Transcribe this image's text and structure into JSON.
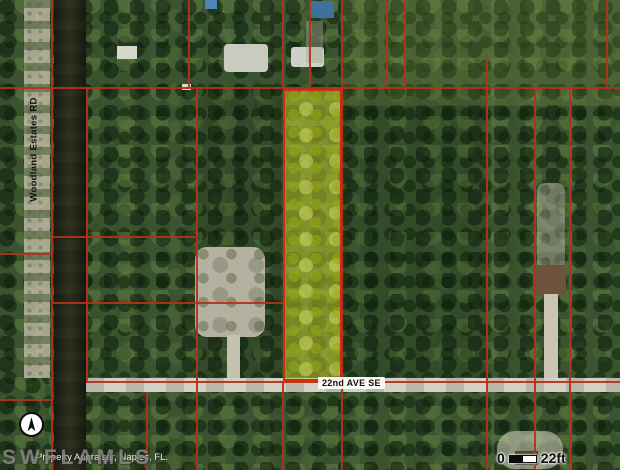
{
  "map": {
    "type": "aerial-parcel-map",
    "labels": {
      "road_horizontal": "22nd AVE SE",
      "road_vertical": "Woodland Estates RD"
    },
    "scale_bar": {
      "start": "0",
      "end": "22ft"
    },
    "watermark": "SWFLAMLS",
    "attribution": "Property Appraiser, Naples, FL.",
    "colors": {
      "parcel_line": "#b3321c",
      "highlight_border": "#d42a10",
      "highlight_fill": "rgba(200,210,40,0.5)",
      "canal": "#232a1b",
      "road": "#d3d0c6",
      "forest_base": "#3a5430"
    },
    "north_arrow_icon": "north-arrow-icon",
    "highlight_parcel": {
      "x": 283,
      "y": 89,
      "w": 59,
      "h": 292
    },
    "parcel_lines": [
      {
        "x": 0,
        "y": 87,
        "w": 620,
        "h": 2
      },
      {
        "x": 51,
        "y": 236,
        "w": 146,
        "h": 2
      },
      {
        "x": 51,
        "y": 302,
        "w": 232,
        "h": 2
      },
      {
        "x": 0,
        "y": 253,
        "w": 51,
        "h": 2
      },
      {
        "x": 86,
        "y": 381,
        "w": 534,
        "h": 2
      },
      {
        "x": 0,
        "y": 399,
        "w": 51,
        "h": 2
      },
      {
        "x": 51,
        "y": 0,
        "w": 2,
        "h": 470
      },
      {
        "x": 86,
        "y": 88,
        "w": 2,
        "h": 295
      },
      {
        "x": 146,
        "y": 392,
        "w": 2,
        "h": 78
      },
      {
        "x": 188,
        "y": 0,
        "w": 2,
        "h": 88
      },
      {
        "x": 196,
        "y": 88,
        "w": 2,
        "h": 382
      },
      {
        "x": 282,
        "y": 0,
        "w": 2,
        "h": 90
      },
      {
        "x": 282,
        "y": 383,
        "w": 2,
        "h": 87
      },
      {
        "x": 309,
        "y": 0,
        "w": 2,
        "h": 88
      },
      {
        "x": 341,
        "y": 0,
        "w": 2,
        "h": 470
      },
      {
        "x": 386,
        "y": 0,
        "w": 2,
        "h": 88
      },
      {
        "x": 404,
        "y": 0,
        "w": 2,
        "h": 88
      },
      {
        "x": 486,
        "y": 55,
        "w": 2,
        "h": 415
      },
      {
        "x": 534,
        "y": 88,
        "w": 2,
        "h": 382
      },
      {
        "x": 569,
        "y": 88,
        "w": 2,
        "h": 382
      },
      {
        "x": 606,
        "y": 0,
        "w": 2,
        "h": 88
      }
    ],
    "structures": [
      {
        "name": "left-trail",
        "cls": "trail",
        "x": 24,
        "y": 0,
        "w": 26,
        "h": 378
      },
      {
        "name": "top-right-light-area",
        "cls": "plain",
        "x": 342,
        "y": 0,
        "w": 278,
        "h": 106,
        "color": "rgba(130,150,70,0.22)"
      },
      {
        "name": "dark-tint-left-of-parcel",
        "cls": "plain",
        "x": 197,
        "y": 88,
        "w": 85,
        "h": 292,
        "color": "rgba(10,25,8,0.16)"
      },
      {
        "name": "dark-tint-right-of-parcel",
        "cls": "plain",
        "x": 344,
        "y": 88,
        "w": 142,
        "h": 292,
        "color": "rgba(10,25,8,0.14)"
      },
      {
        "name": "swimming-pool",
        "cls": "plain",
        "x": 205,
        "y": 0,
        "w": 12,
        "h": 9,
        "color": "#4e86b4"
      },
      {
        "name": "house-roof-a",
        "cls": "plain",
        "x": 117,
        "y": 46,
        "w": 20,
        "h": 13,
        "color": "#d6d7cd"
      },
      {
        "name": "house-roof-b",
        "cls": "plain",
        "x": 224,
        "y": 44,
        "w": 44,
        "h": 28,
        "color": "#cbcabf",
        "radius": 4
      },
      {
        "name": "shed-roof",
        "cls": "plain",
        "x": 182,
        "y": 84,
        "w": 9,
        "h": 6,
        "color": "#d9d9cd"
      },
      {
        "name": "house-roof-c",
        "cls": "plain",
        "x": 291,
        "y": 47,
        "w": 33,
        "h": 20,
        "color": "#ced1c7",
        "radius": 3
      },
      {
        "name": "blue-roof-house",
        "cls": "plain",
        "x": 309,
        "y": 1,
        "w": 25,
        "h": 17,
        "color": "#3f719f"
      },
      {
        "name": "yard-patch",
        "cls": "plain",
        "x": 306,
        "y": 21,
        "w": 17,
        "h": 42,
        "color": "rgba(165,165,145,0.45)"
      },
      {
        "name": "cleared-lot",
        "cls": "clearing",
        "x": 195,
        "y": 247,
        "w": 70,
        "h": 90,
        "radius": 12
      },
      {
        "name": "driveway-left",
        "cls": "plain",
        "x": 227,
        "y": 335,
        "w": 13,
        "h": 46,
        "color": "#c6c2b0"
      },
      {
        "name": "cleared-strip-right",
        "cls": "clearing",
        "x": 537,
        "y": 183,
        "w": 28,
        "h": 86,
        "radius": 8,
        "opacity": 0.55
      },
      {
        "name": "house-roof-brown",
        "cls": "plain",
        "x": 533,
        "y": 265,
        "w": 33,
        "h": 30,
        "color": "#6e523c",
        "radius": 2
      },
      {
        "name": "driveway-right",
        "cls": "plain",
        "x": 544,
        "y": 294,
        "w": 14,
        "h": 86,
        "color": "#c9c5b2"
      },
      {
        "name": "circular-driveway",
        "cls": "plain",
        "x": 497,
        "y": 431,
        "w": 66,
        "h": 38,
        "color": "rgba(205,200,184,0.6)",
        "radius": 18
      },
      {
        "name": "house-roof-dark",
        "cls": "plain",
        "x": 515,
        "y": 451,
        "w": 23,
        "h": 14,
        "color": "#4d4639"
      }
    ]
  }
}
